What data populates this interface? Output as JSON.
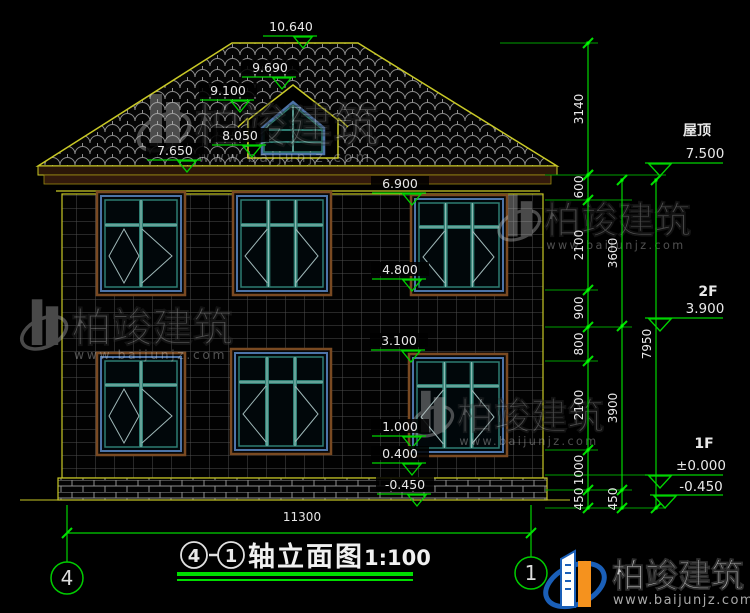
{
  "page": {
    "background": "#000000"
  },
  "title_block": {
    "axis_start": "4",
    "dash": "-",
    "axis_end": "1",
    "name": "轴立面图",
    "scale": "1:100"
  },
  "axis_bubbles": {
    "left": "4",
    "right": "1"
  },
  "overall_dim": {
    "value": "11300"
  },
  "levels": [
    {
      "label": "屋顶",
      "value": "7.500",
      "lx": 697,
      "ly": 135,
      "vx": 705,
      "vy": 158,
      "line_y": 163,
      "x1": 645,
      "x2": 723,
      "tri_x": 649
    },
    {
      "label": "2F",
      "value": "3.900",
      "lx": 708,
      "ly": 296,
      "vx": 705,
      "vy": 313,
      "line_y": 318,
      "x1": 645,
      "x2": 723,
      "tri_x": 649
    },
    {
      "label": "1F",
      "value": "±0.000",
      "lx": 704,
      "ly": 448,
      "vx": 701,
      "vy": 470,
      "line_y": 475,
      "x1": 645,
      "x2": 723,
      "tri_x": 649
    },
    {
      "label": "",
      "value": "-0.450",
      "lx": 0,
      "ly": 0,
      "vx": 701,
      "vy": 491,
      "line_y": 495,
      "x1": 650,
      "x2": 723,
      "tri_x": 654
    }
  ],
  "elevation_markers": [
    {
      "value": "10.640",
      "x": 291,
      "y": 31
    },
    {
      "value": "9.690",
      "x": 270,
      "y": 72
    },
    {
      "value": "9.100",
      "x": 228,
      "y": 95
    },
    {
      "value": "8.050",
      "x": 240,
      "y": 140
    },
    {
      "value": "7.650",
      "x": 175,
      "y": 155
    },
    {
      "value": "6.900",
      "x": 400,
      "y": 188
    },
    {
      "value": "4.800",
      "x": 400,
      "y": 274
    },
    {
      "value": "3.100",
      "x": 399,
      "y": 345
    },
    {
      "value": "1.000",
      "x": 400,
      "y": 431
    },
    {
      "value": "0.400",
      "x": 400,
      "y": 458
    },
    {
      "value": "-0.450",
      "x": 405,
      "y": 489
    }
  ],
  "dimension_chains": [
    {
      "x": 588,
      "pts": [
        43,
        175
      ],
      "labels": [
        {
          "t": "3140",
          "y": 109
        }
      ]
    },
    {
      "x": 588,
      "pts": [
        175,
        200,
        290,
        327,
        361,
        450,
        490,
        508
      ],
      "labels": [
        {
          "t": "600",
          "y": 187
        },
        {
          "t": "2100",
          "y": 245
        },
        {
          "t": "900",
          "y": 308
        },
        {
          "t": "800",
          "y": 344
        },
        {
          "t": "2100",
          "y": 405
        },
        {
          "t": "1000",
          "y": 470
        },
        {
          "t": "450",
          "y": 499
        }
      ]
    },
    {
      "x": 622,
      "pts": [
        180,
        326,
        490,
        508
      ],
      "labels": [
        {
          "t": "3600",
          "y": 253
        },
        {
          "t": "3900",
          "y": 408
        },
        {
          "t": "450",
          "y": 499
        }
      ]
    },
    {
      "x": 656,
      "pts": [
        180,
        508
      ],
      "labels": [
        {
          "t": "7950",
          "y": 344
        }
      ]
    }
  ],
  "extension_lines": [
    [
      500,
      43,
      598,
      43
    ],
    [
      545,
      175,
      666,
      175
    ],
    [
      545,
      200,
      632,
      200
    ],
    [
      545,
      290,
      598,
      290
    ],
    [
      545,
      327,
      632,
      327
    ],
    [
      545,
      361,
      598,
      361
    ],
    [
      545,
      450,
      598,
      450
    ],
    [
      545,
      475,
      648,
      475
    ],
    [
      545,
      490,
      632,
      490
    ],
    [
      545,
      508,
      666,
      508
    ]
  ],
  "windows": [
    {
      "x": 101,
      "y": 196,
      "w": 80,
      "h": 95,
      "panels": 2,
      "floor": "2F"
    },
    {
      "x": 237,
      "y": 196,
      "w": 90,
      "h": 95,
      "panels": 3,
      "floor": "2F"
    },
    {
      "x": 415,
      "y": 199,
      "w": 88,
      "h": 92,
      "panels": 3,
      "floor": "2F"
    },
    {
      "x": 101,
      "y": 357,
      "w": 80,
      "h": 94,
      "panels": 2,
      "floor": "1F"
    },
    {
      "x": 235,
      "y": 353,
      "w": 92,
      "h": 97,
      "panels": 3,
      "floor": "1F"
    },
    {
      "x": 413,
      "y": 358,
      "w": 90,
      "h": 94,
      "panels": 3,
      "floor": "1F"
    }
  ],
  "watermarks": {
    "brand": "柏竣建筑",
    "url": "www.baijunjz.com",
    "instances": [
      {
        "x": 140,
        "y": 88,
        "s": 1.0
      },
      {
        "x": 23,
        "y": 294,
        "s": 0.88
      },
      {
        "x": 500,
        "y": 190,
        "s": 0.8
      },
      {
        "x": 413,
        "y": 386,
        "s": 0.8
      }
    ]
  },
  "logo": {
    "brand": "柏竣建筑",
    "url": "www.baijunjz.com"
  },
  "colors": {
    "dim_green": "#00d400",
    "node_green": "#00ff00",
    "outline_yellow": "#c9c926",
    "eave_brown": "#331a0c",
    "frame_teal": "#2e7d72",
    "frame_light": "#9fc7c0",
    "frame_blue": "#4d74a8",
    "trim_brown": "#7a4a22",
    "text_white": "#e8e8e8",
    "grid_gray": "#4e4e4e",
    "tile_gray": "#8f8f8f",
    "logo_blue": "#1a5fb8",
    "logo_orange": "#f5921e"
  }
}
